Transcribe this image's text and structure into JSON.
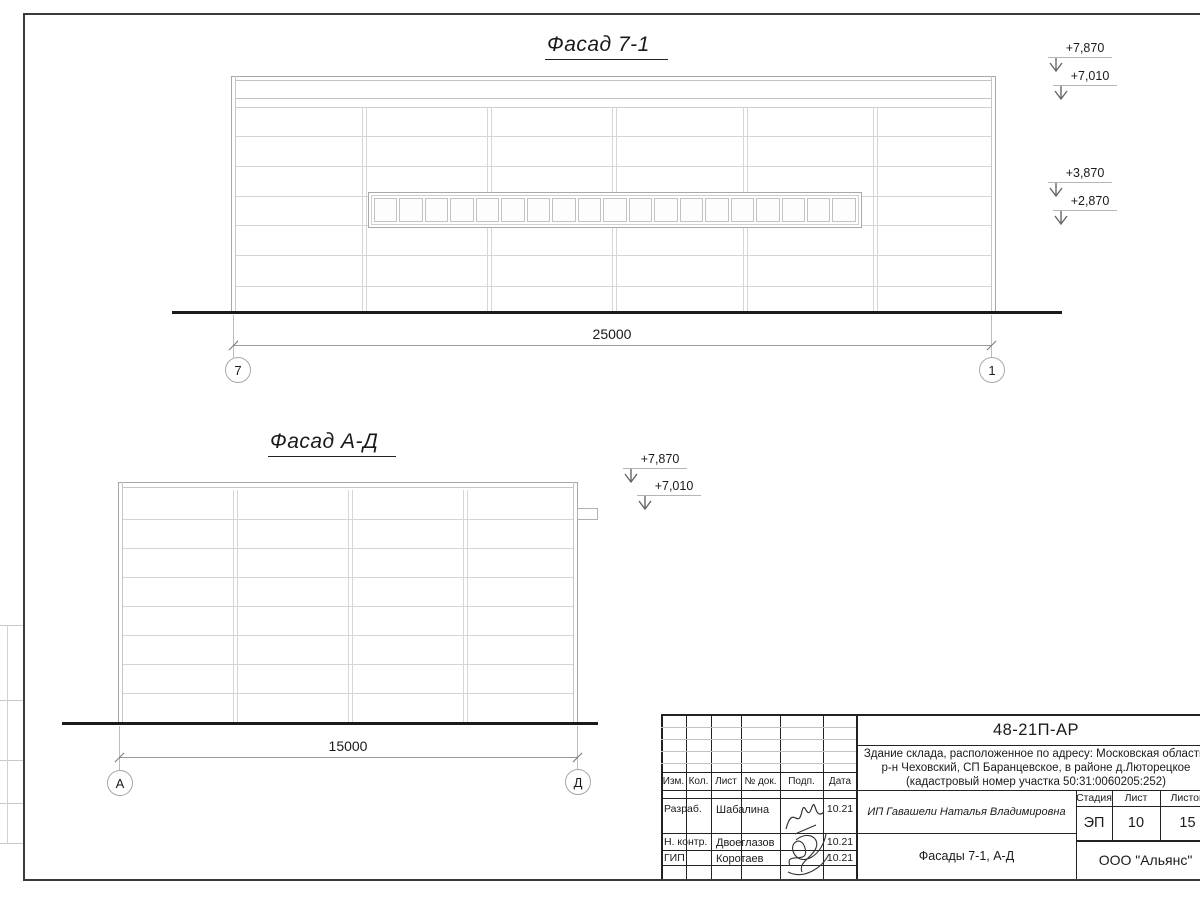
{
  "facade_7_1": {
    "title": "Фасад 7-1",
    "dimension_label": "25000",
    "axis_left": "7",
    "axis_right": "1",
    "elevations": [
      "+7,870",
      "+7,010",
      "+3,870",
      "+2,870"
    ],
    "window_pane_count": 19,
    "bay_count": 6,
    "siding_row_count": 7
  },
  "facade_a_d": {
    "title": "Фасад А-Д",
    "dimension_label": "15000",
    "axis_left": "А",
    "axis_right": "Д",
    "elevations": [
      "+7,870",
      "+7,010"
    ],
    "bay_count": 4,
    "siding_row_count": 8
  },
  "title_block": {
    "doc_code": "48-21П-АР",
    "description_lines": [
      "Здание склада, расположенное по адресу: Московская область,",
      "р-н Чеховский, СП Баранцевское, в районе д.Люторецкое",
      "(кадастровый номер участка 50:31:0060205:252)"
    ],
    "change_table_headers": [
      "Изм.",
      "Кол.",
      "Лист",
      "№ док.",
      "Подп.",
      "Дата"
    ],
    "signature_rows": [
      {
        "role": "Разраб.",
        "name": "Шабалина",
        "date": "10.21"
      },
      {
        "role": "Н. контр.",
        "name": "Двоеглазов",
        "date": "10.21"
      },
      {
        "role": "ГИП",
        "name": "Коротаев",
        "date": "10.21"
      }
    ],
    "client": "ИП Гавашели Наталья Владимировна",
    "sheet_title": "Фасады 7-1, А-Д",
    "company": "ООО \"Альянс\"",
    "stage_label": "Стадия",
    "stage_value": "ЭП",
    "sheet_label": "Лист",
    "sheet_value": "10",
    "total_label": "Листов",
    "total_value": "15"
  }
}
